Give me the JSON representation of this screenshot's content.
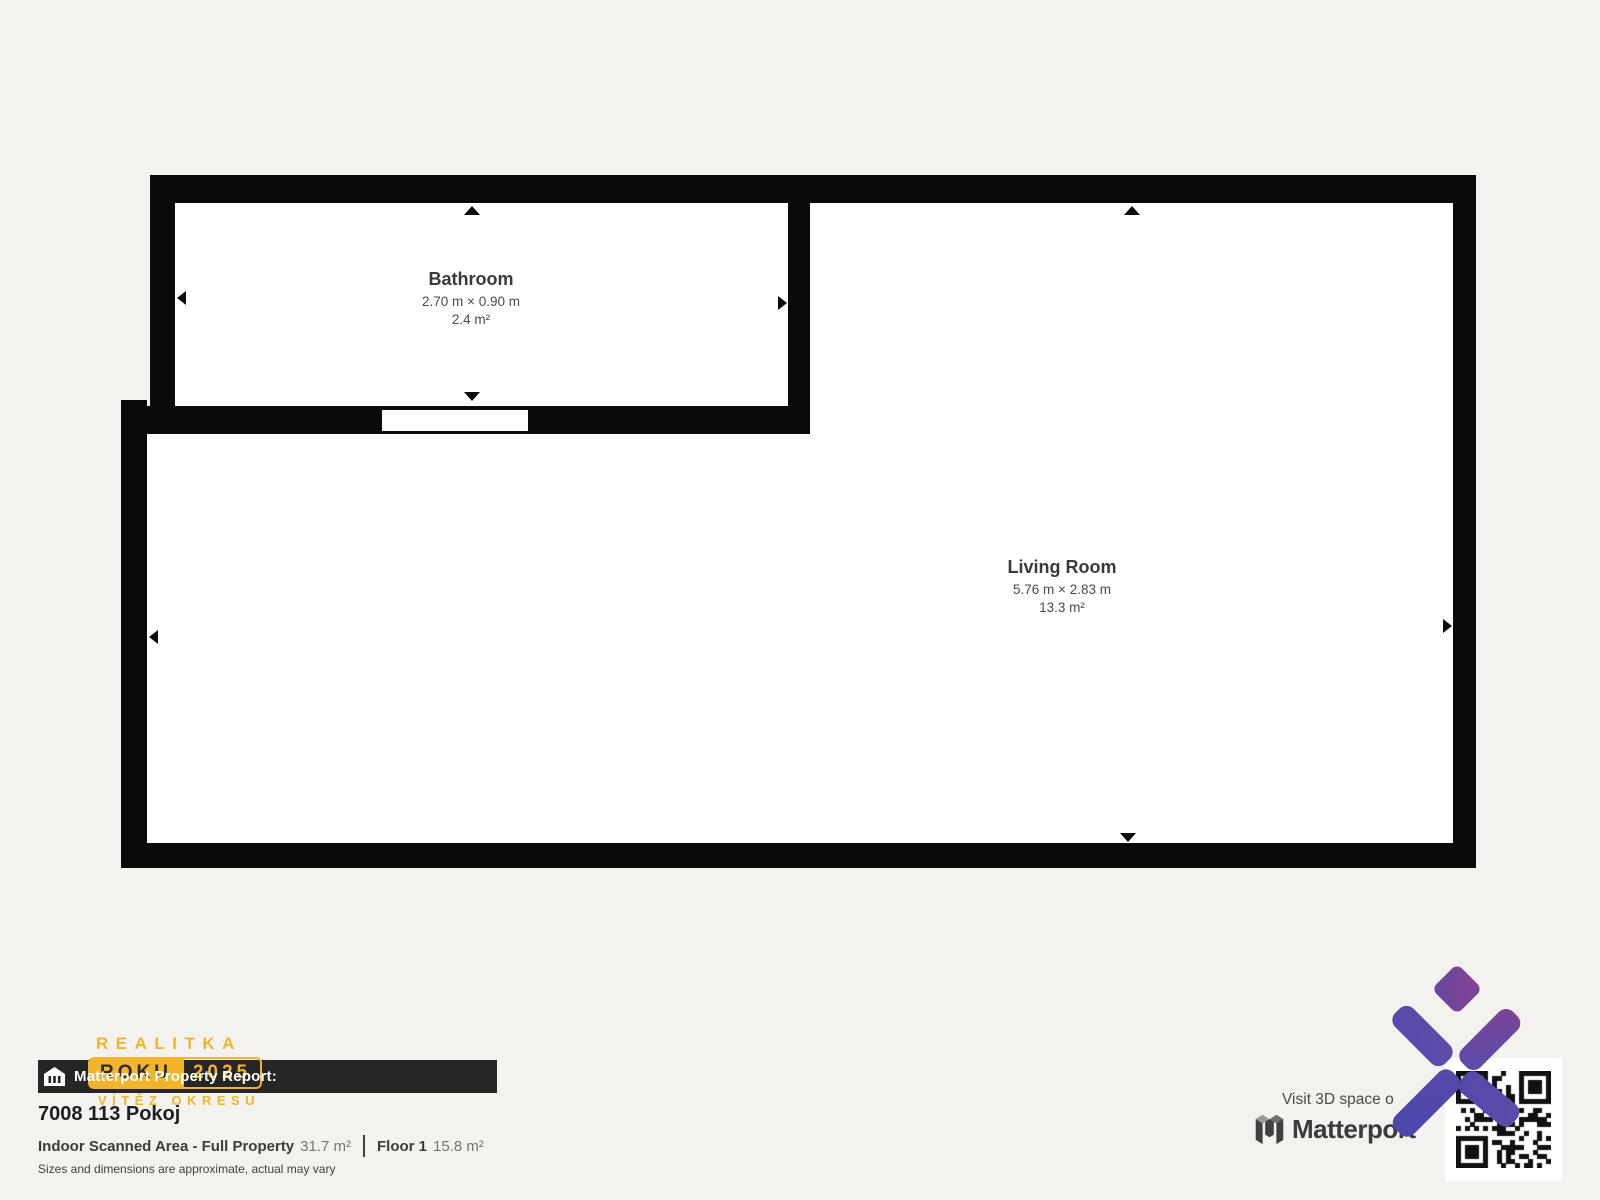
{
  "page": {
    "background": "#f4f2ef"
  },
  "floorplan": {
    "wall_color": "#0a0a0a",
    "room_fill": "#ffffff",
    "rooms": [
      {
        "name": "Bathroom",
        "dimensions": "2.70 m × 0.90 m",
        "area": "2.4 m²"
      },
      {
        "name": "Living Room",
        "dimensions": "5.76 m × 2.83 m",
        "area": "13.3 m²"
      }
    ]
  },
  "footer": {
    "bar_label": "Matterport Property Report:",
    "bar_icon": "building-icon",
    "property_title": "7008 113 Pokoj",
    "scanned_label": "Indoor Scanned Area - Full Property",
    "scanned_value": "31.7 m²",
    "floor_label": "Floor 1",
    "floor_value": "15.8 m²",
    "disclaimer": "Sizes and dimensions are approximate, actual may vary"
  },
  "agency_logo": {
    "line1": "REALITKA",
    "badge_left": "ROKU",
    "badge_right": "2025",
    "line2": "VÍTĚZ OKRESU",
    "accent_color": "#F2B42C"
  },
  "matterport": {
    "visit_text": "Visit 3D space o",
    "brand": "Matterport",
    "gradient_start": "#4747AB",
    "gradient_end": "#9A3D85"
  }
}
